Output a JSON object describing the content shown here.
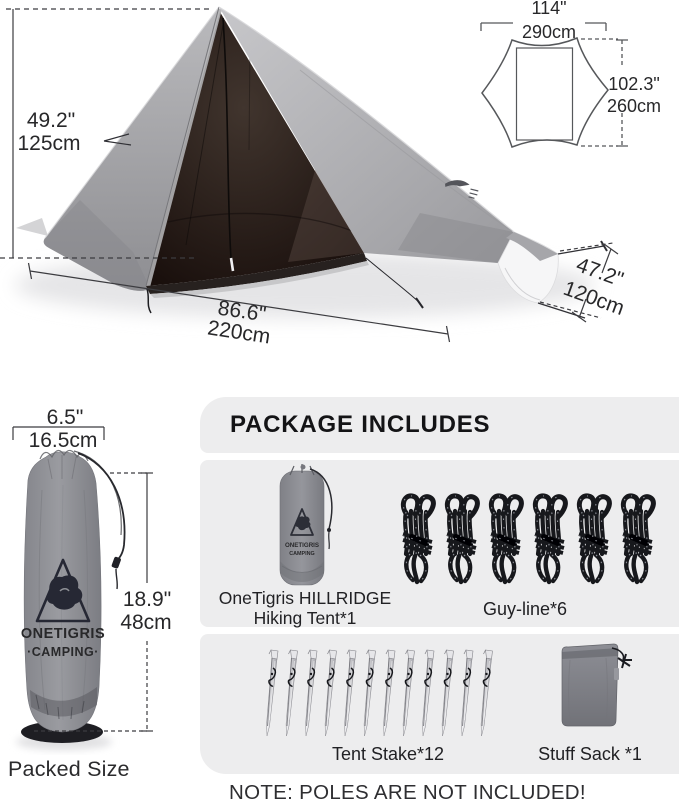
{
  "tent": {
    "height_in": "49.2\"",
    "height_cm": "125cm",
    "length_in": "86.6\"",
    "length_cm": "220cm",
    "front_in": "47.2\"",
    "front_cm": "120cm"
  },
  "footprint": {
    "width_in": "114\"",
    "width_cm": "290cm",
    "depth_in": "102.3\"",
    "depth_cm": "260cm"
  },
  "packed": {
    "width_in": "6.5\"",
    "width_cm": "16.5cm",
    "height_in": "18.9\"",
    "height_cm": "48cm",
    "caption": "Packed Size",
    "bag_brand": "ONETIGRIS",
    "bag_sub": "·CAMPING·"
  },
  "package": {
    "title": "PACKAGE INCLUDES",
    "tent_item_line1": "OneTigris HILLRIDGE",
    "tent_item_line2": "Hiking Tent*1",
    "small_bag_brand": "ONETIGRIS",
    "small_bag_sub": "CAMPING",
    "guyline_label": "Guy-line*6",
    "stake_label": "Tent Stake*12",
    "sack_label": "Stuff Sack *1",
    "note": "NOTE: POLES ARE NOT INCLUDED!"
  },
  "colors": {
    "panel_bg": "#ededee",
    "fabric_gray": "#a7a7ab",
    "interior_dark": "#27201e",
    "rope_black": "#17181c",
    "bag_gray": "#8e9095",
    "dim_line": "#3c3c40",
    "text": "#1e1e20"
  }
}
